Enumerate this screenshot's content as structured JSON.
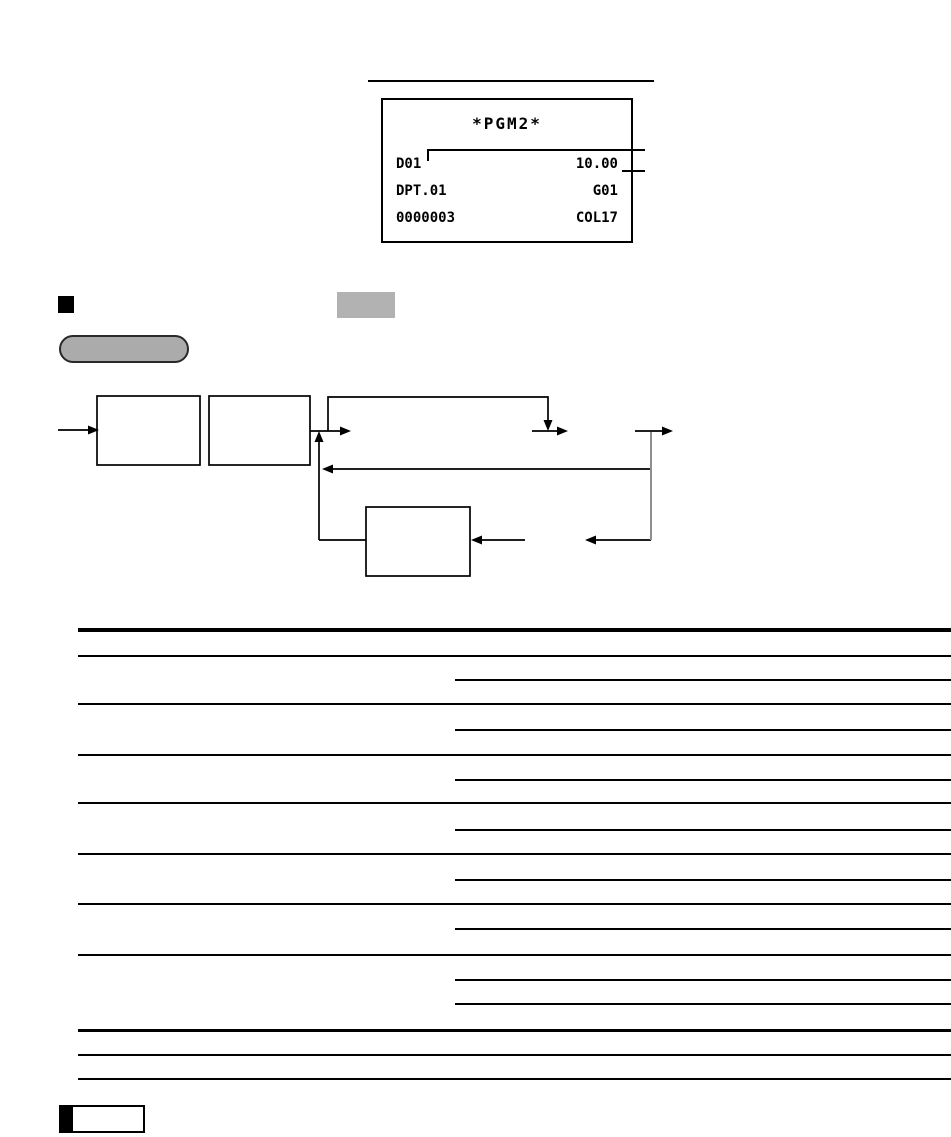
{
  "receipt": {
    "header": "*PGM2*",
    "rows": [
      {
        "left": "D01",
        "right": "10.00"
      },
      {
        "left": "DPT.01",
        "right": "G01"
      },
      {
        "left": "0000003",
        "right": "COL17"
      }
    ]
  },
  "colors": {
    "page_background": "#ffffff",
    "ink": "#000000",
    "key_highlight_gray": "#b2b2b2",
    "procedure_pill_fill": "#ababab",
    "procedure_pill_border": "#2a2a2a",
    "diagram_drop_line_gray": "#8f8f8f"
  },
  "icons": {
    "section_marker": "black-filled-square",
    "note_tab_bar": "black-filled-bar"
  }
}
